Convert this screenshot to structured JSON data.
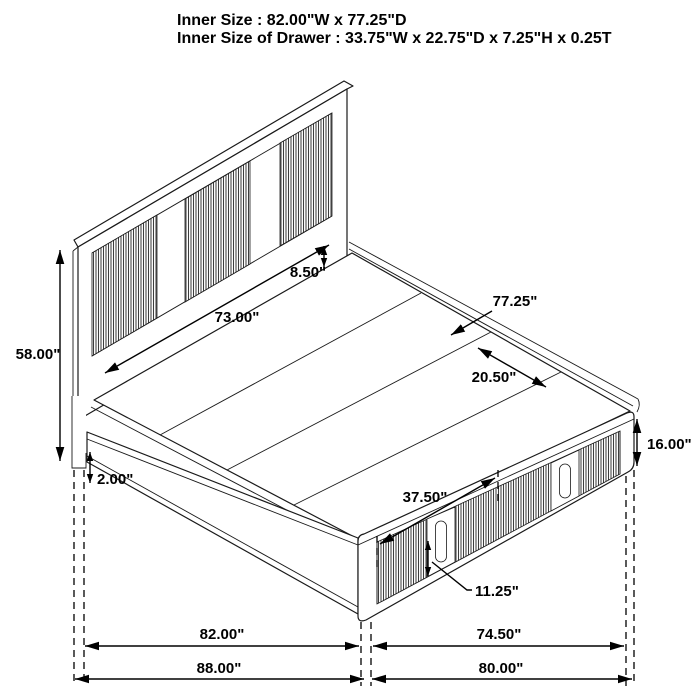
{
  "title": {
    "line1": "Inner Size : 82.00\"W x 77.25\"D",
    "line2": "Inner Size of Drawer : 33.75\"W x 22.75\"D x 7.25\"H x 0.25T"
  },
  "dimensions": {
    "headboard_height": "58.00\"",
    "headboard_inner_width": "73.00\"",
    "headboard_rail_height": "8.50\"",
    "inner_depth": "77.25\"",
    "slat_spacing": "20.50\"",
    "footboard_height": "16.00\"",
    "drawer_width": "37.50\"",
    "drawer_front_height": "11.25\"",
    "leg_clearance": "2.00\"",
    "inner_width": "82.00\"",
    "footboard_side_length": "74.50\"",
    "overall_width": "88.00\"",
    "overall_depth": "80.00\""
  }
}
